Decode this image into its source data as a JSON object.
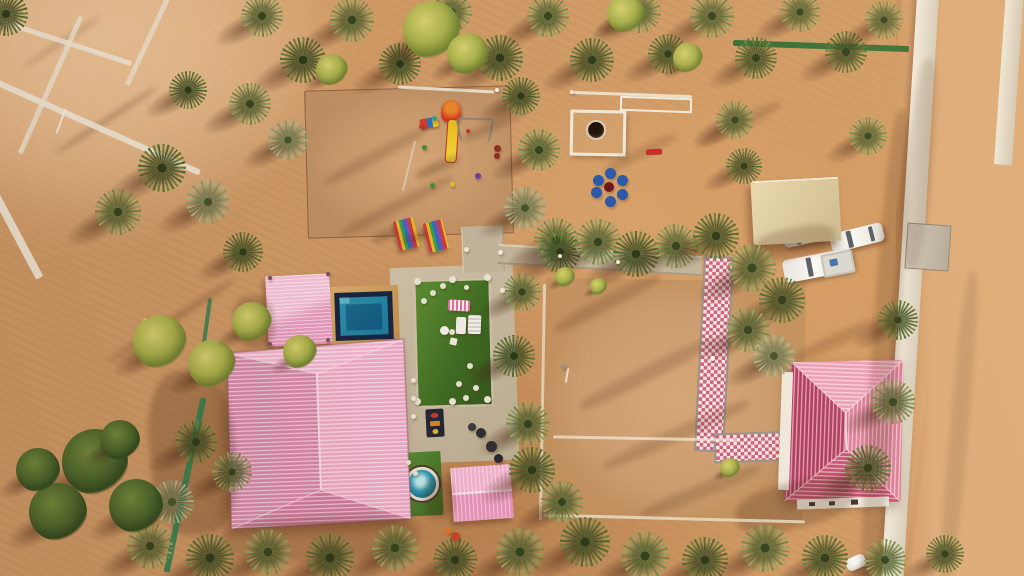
{
  "meta": {
    "subject": "aerial-drone-photo-desert-farm-resort",
    "time_of_day": "golden-hour",
    "no_visible_text": true
  },
  "palette": {
    "sand": "#cf9a66",
    "sand_light": "#eec89c",
    "sand_shadow": "#8a5431",
    "roof_pink_light": "#f2abc6",
    "roof_pink_dark": "#d887aa",
    "roof_red_house": "#c84f70",
    "pool_water": "#2187b0",
    "pool_deep": "#14618c",
    "pool_frame": "#172440",
    "pool_deck": "#cf9f5e",
    "turf_green": "#4a7a28",
    "concrete": "#c2b49a",
    "canopy_beige": "#e0d0a6",
    "checker_pink": "#cf5f7e",
    "fence_green": "#2c6b33",
    "car_white": "#f4f4f0",
    "seat_blue": "#2a58a8",
    "slide_yellow": "#eec31f",
    "tower_red": "#cf2f23",
    "palm_olive": "#79894a",
    "palm_dark": "#5a6c33"
  },
  "scene": {
    "palms": [
      [
        262,
        16,
        42,
        0
      ],
      [
        303,
        60,
        46,
        1
      ],
      [
        352,
        20,
        44,
        0
      ],
      [
        400,
        64,
        42,
        1
      ],
      [
        452,
        12,
        40,
        0
      ],
      [
        500,
        58,
        46,
        1
      ],
      [
        548,
        16,
        42,
        0
      ],
      [
        592,
        60,
        44,
        1
      ],
      [
        640,
        12,
        42,
        0
      ],
      [
        668,
        54,
        40,
        1
      ],
      [
        712,
        16,
        44,
        0
      ],
      [
        756,
        58,
        42,
        1
      ],
      [
        800,
        12,
        40,
        0
      ],
      [
        846,
        52,
        42,
        1
      ],
      [
        884,
        20,
        38,
        0
      ],
      [
        6,
        14,
        44,
        1
      ],
      [
        735,
        120,
        38,
        0
      ],
      [
        188,
        90,
        38,
        1
      ],
      [
        250,
        104,
        42,
        0
      ],
      [
        288,
        140,
        40,
        2
      ],
      [
        162,
        168,
        48,
        1
      ],
      [
        118,
        212,
        46,
        0
      ],
      [
        208,
        202,
        44,
        2
      ],
      [
        243,
        252,
        40,
        1
      ],
      [
        521,
        96,
        38,
        1
      ],
      [
        539,
        150,
        42,
        0
      ],
      [
        525,
        208,
        42,
        2
      ],
      [
        556,
        240,
        44,
        0
      ],
      [
        560,
        252,
        42,
        1
      ],
      [
        598,
        242,
        46,
        0
      ],
      [
        636,
        254,
        46,
        1
      ],
      [
        676,
        246,
        44,
        0
      ],
      [
        716,
        236,
        46,
        1
      ],
      [
        752,
        268,
        48,
        0
      ],
      [
        782,
        300,
        46,
        1
      ],
      [
        748,
        330,
        44,
        0
      ],
      [
        774,
        356,
        42,
        2
      ],
      [
        744,
        166,
        36,
        1
      ],
      [
        868,
        136,
        38,
        0
      ],
      [
        898,
        320,
        40,
        1
      ],
      [
        893,
        402,
        44,
        0
      ],
      [
        868,
        468,
        46,
        1
      ],
      [
        522,
        292,
        38,
        0
      ],
      [
        514,
        356,
        42,
        1
      ],
      [
        528,
        424,
        44,
        0
      ],
      [
        532,
        470,
        46,
        1
      ],
      [
        562,
        502,
        42,
        0
      ],
      [
        196,
        442,
        42,
        1
      ],
      [
        232,
        472,
        40,
        0
      ],
      [
        172,
        502,
        44,
        2
      ],
      [
        150,
        546,
        46,
        0
      ],
      [
        210,
        558,
        48,
        1
      ],
      [
        268,
        552,
        46,
        0
      ],
      [
        330,
        558,
        48,
        1
      ],
      [
        395,
        548,
        46,
        0
      ],
      [
        455,
        560,
        44,
        1
      ],
      [
        520,
        552,
        48,
        0
      ],
      [
        585,
        542,
        50,
        1
      ],
      [
        645,
        556,
        48,
        0
      ],
      [
        705,
        560,
        46,
        1
      ],
      [
        765,
        548,
        48,
        0
      ],
      [
        825,
        558,
        46,
        1
      ],
      [
        885,
        560,
        42,
        0
      ],
      [
        945,
        554,
        38,
        1
      ]
    ],
    "bushes": [
      [
        432,
        30,
        58
      ],
      [
        332,
        70,
        32
      ],
      [
        626,
        14,
        38
      ],
      [
        688,
        58,
        30
      ],
      [
        468,
        54,
        42
      ],
      [
        160,
        342,
        54
      ],
      [
        212,
        364,
        48
      ],
      [
        252,
        322,
        40
      ],
      [
        300,
        352,
        34
      ],
      [
        565,
        277,
        20
      ],
      [
        598,
        286,
        17
      ],
      [
        730,
        468,
        20
      ]
    ],
    "leafy_trees": [
      [
        95,
        462,
        66
      ],
      [
        58,
        512,
        58
      ],
      [
        136,
        506,
        54
      ],
      [
        38,
        470,
        44
      ],
      [
        120,
        440,
        40
      ]
    ],
    "shadow_streaks": [
      [
        150,
        370,
        85,
        165,
        -5,
        0.26
      ],
      [
        735,
        482,
        120,
        46,
        -14,
        0.24
      ],
      [
        752,
        228,
        84,
        30,
        -12,
        0.22
      ],
      [
        872,
        110,
        26,
        480,
        4,
        0.2
      ],
      [
        234,
        296,
        40,
        52,
        -8,
        0.24
      ],
      [
        424,
        478,
        30,
        40,
        -6,
        0.24
      ],
      [
        548,
        296,
        120,
        13,
        -27,
        0.18
      ],
      [
        572,
        366,
        150,
        15,
        -27,
        0.18
      ],
      [
        596,
        428,
        160,
        14,
        -24,
        0.18
      ],
      [
        318,
        150,
        115,
        12,
        -28,
        0.18
      ],
      [
        334,
        200,
        125,
        12,
        -27,
        0.18
      ],
      [
        46,
        118,
        120,
        5,
        -33,
        0.28
      ],
      [
        96,
        318,
        150,
        6,
        -33,
        0.28
      ],
      [
        16,
        40,
        92,
        4,
        -33,
        0.22
      ],
      [
        908,
        58,
        24,
        210,
        5,
        0.14
      ],
      [
        950,
        270,
        18,
        320,
        5,
        0.12
      ],
      [
        694,
        118,
        92,
        12,
        -27,
        0.18
      ],
      [
        600,
        148,
        80,
        11,
        -27,
        0.16
      ],
      [
        790,
        332,
        100,
        13,
        -24,
        0.18
      ],
      [
        636,
        484,
        130,
        14,
        -22,
        0.18
      ],
      [
        372,
        232,
        26,
        8,
        -20,
        0.28
      ],
      [
        402,
        234,
        26,
        8,
        -20,
        0.28
      ],
      [
        414,
        162,
        48,
        10,
        -24,
        0.26
      ],
      [
        220,
        516,
        200,
        44,
        -3,
        0.16
      ],
      [
        460,
        120,
        70,
        10,
        -25,
        0.2
      ]
    ],
    "strips": [
      [
        -15,
        38,
        150,
        5,
        18,
        "#f2ead9",
        0.85
      ],
      [
        -25,
        122,
        235,
        6,
        24,
        "#f2ead9",
        0.9
      ],
      [
        48,
        10,
        5,
        150,
        24,
        "#efe7d6",
        0.8
      ],
      [
        148,
        -20,
        5,
        110,
        25,
        "#efe7d6",
        0.75
      ],
      [
        -30,
        232,
        95,
        8,
        62,
        "#f2ecdd",
        0.9
      ],
      [
        60,
        108,
        2,
        26,
        20,
        "#f5f0e2",
        0.9
      ],
      [
        140,
        318,
        2,
        28,
        16,
        "#f5f0e2",
        0.9
      ],
      [
        733,
        43,
        176,
        6,
        2,
        "#2c6b33",
        0.95
      ],
      [
        96,
        482,
        178,
        6,
        -78,
        "#2e7d4f",
        0.9
      ],
      [
        205,
        298,
        4,
        46,
        8,
        "#2e7a50",
        0.8
      ],
      [
        541,
        284,
        3,
        236,
        1,
        "#e7dcc4",
        0.8
      ],
      [
        543,
        517,
        262,
        3,
        1.5,
        "#e7dcc4",
        0.85
      ],
      [
        553,
        437,
        184,
        2.5,
        1,
        "#f3ecda",
        0.7
      ],
      [
        570,
        93,
        122,
        2.5,
        2,
        "#f1ebdc",
        0.85
      ],
      [
        398,
        88,
        96,
        2.5,
        3,
        "#efeadb",
        0.85
      ],
      [
        566,
        368,
        2,
        15,
        10,
        "#ece6d6",
        0.9
      ],
      [
        408,
        140,
        2,
        52,
        14,
        "#d9cfc0",
        0.8
      ],
      [
        646,
        149,
        16,
        6,
        -3,
        "#c42c28",
        1
      ]
    ],
    "dots": [
      [
        417,
        281,
        7,
        "#ece5d4",
        "baluster"
      ],
      [
        452,
        279,
        7,
        "#ece5d4",
        "baluster"
      ],
      [
        487,
        277,
        7,
        "#ece5d4",
        "baluster"
      ],
      [
        417,
        401,
        7,
        "#ece5d4",
        "baluster"
      ],
      [
        452,
        401,
        7,
        "#ece5d4",
        "baluster"
      ],
      [
        487,
        399,
        7,
        "#ece5d4",
        "baluster"
      ],
      [
        466,
        249,
        5,
        "#efe8d6",
        "post"
      ],
      [
        500,
        252,
        5,
        "#efe8d6",
        "post"
      ],
      [
        466,
        287,
        5,
        "#efe8d6",
        "post"
      ],
      [
        502,
        290,
        5,
        "#efe8d6",
        "post"
      ],
      [
        560,
        256,
        4,
        "#efe8d6",
        "post"
      ],
      [
        618,
        262,
        4,
        "#efe8d6",
        "post"
      ],
      [
        424,
        301,
        6,
        "#e9e3d2",
        "stepping-stone"
      ],
      [
        433,
        293,
        6,
        "#e9e3d2",
        "stepping-stone"
      ],
      [
        443,
        286,
        6,
        "#e9e3d2",
        "stepping-stone"
      ],
      [
        452,
        332,
        6,
        "#e9e3d2",
        "stepping-stone"
      ],
      [
        470,
        366,
        6,
        "#e9e3d2",
        "stepping-stone"
      ],
      [
        459,
        384,
        6,
        "#e9e3d2",
        "stepping-stone"
      ],
      [
        476,
        388,
        6,
        "#e9e3d2",
        "stepping-stone"
      ],
      [
        466,
        398,
        6,
        "#e9e3d2",
        "stepping-stone"
      ],
      [
        408,
        462,
        5,
        "#e9e3d2",
        "stepping-stone"
      ],
      [
        415,
        473,
        5,
        "#e9e3d2",
        "stepping-stone"
      ],
      [
        413,
        380,
        5,
        "#efe8d6",
        "baluster"
      ],
      [
        413,
        398,
        5,
        "#efe8d6",
        "baluster"
      ],
      [
        413,
        416,
        5,
        "#efe8d6",
        "baluster"
      ],
      [
        270,
        278,
        4,
        "#7a525c",
        "gazebo-post"
      ],
      [
        328,
        274,
        4,
        "#7a525c",
        "gazebo-post"
      ],
      [
        270,
        344,
        4,
        "#7a525c",
        "gazebo-post"
      ],
      [
        328,
        340,
        4,
        "#7a525c",
        "gazebo-post"
      ],
      [
        598,
        180,
        11,
        "#2a58a8",
        "blue-seat"
      ],
      [
        610,
        173,
        11,
        "#2a58a8",
        "blue-seat"
      ],
      [
        622,
        180,
        11,
        "#2a58a8",
        "blue-seat"
      ],
      [
        622,
        194,
        11,
        "#2a58a8",
        "blue-seat"
      ],
      [
        610,
        201,
        11,
        "#2a58a8",
        "blue-seat"
      ],
      [
        596,
        192,
        11,
        "#2a58a8",
        "blue-seat"
      ],
      [
        609,
        187,
        10,
        "#6e1518",
        "fire-pit"
      ],
      [
        472,
        427,
        8,
        "#3a3a40",
        "grill"
      ],
      [
        481,
        433,
        10,
        "#2e2e34",
        "grill"
      ],
      [
        491,
        446,
        11,
        "#2e2e34",
        "grill"
      ],
      [
        498,
        458,
        9,
        "#26262c",
        "grill"
      ],
      [
        455,
        536,
        9,
        "#cc4422",
        "cart"
      ],
      [
        448,
        531,
        6,
        "#e07722",
        "cart"
      ],
      [
        424,
        147,
        5,
        "#3e8e3a",
        "toy"
      ],
      [
        432,
        185,
        5,
        "#3e8e3a",
        "toy"
      ],
      [
        478,
        176,
        6,
        "#6a3f9e",
        "toy"
      ],
      [
        452,
        184,
        5,
        "#d8c22a",
        "toy"
      ],
      [
        434,
        118,
        5,
        "#2a9e96",
        "toy"
      ],
      [
        421,
        126,
        5,
        "#c5312e",
        "toy"
      ],
      [
        468,
        131,
        4,
        "#c5312e",
        "swing-seat"
      ],
      [
        497,
        148,
        7,
        "#8f2d23",
        "toy"
      ],
      [
        497,
        156,
        6,
        "#8f2d23",
        "toy"
      ],
      [
        497,
        90,
        4,
        "#f2efe8",
        "person"
      ],
      [
        572,
        92,
        4,
        "#e8e4da",
        "person"
      ],
      [
        712,
        358,
        5,
        "#f2efe8",
        "person"
      ],
      [
        563,
        366,
        5,
        "#9a958a",
        "flag"
      ]
    ]
  }
}
